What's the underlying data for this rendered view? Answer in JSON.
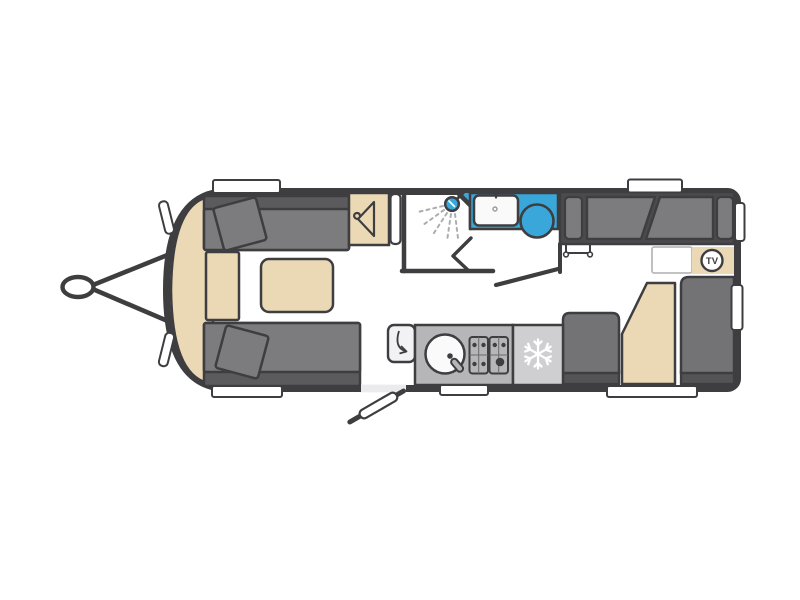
{
  "page": {
    "title": "Caravan floor plan (top-down layout diagram)",
    "background": "#ffffff"
  },
  "labels": {
    "tv": "TV"
  },
  "colors": {
    "outline_wall": "#3E3E40",
    "floor": "#EBEBED",
    "upholstery_gray": "#7C7C7E",
    "upholstery_dark": "#5B5B5D",
    "bed_base_dark": "#4B4B4D",
    "dinette_gray": "#737375",
    "wood_beige": "#EBD9B6",
    "wet_area_blue": "#3AA7DA",
    "worktop_gray": "#B6B6B8",
    "fridge_gray": "#CFCFD1",
    "white": "#FFFFFF",
    "spray_gray": "#ADADAF"
  },
  "icons": [
    "coat-hanger-icon",
    "shower-head-icon",
    "snowflake-icon",
    "tv-badge-icon",
    "hob-burners-icon",
    "sink-tap-icon",
    "flap-swing-arrow-icon"
  ],
  "floorplan": {
    "view": "top-down",
    "hitch": "A-frame tow hitch on left (front) end",
    "areas": [
      {
        "name": "front-lounge",
        "features": [
          "sofa with cushion (top)",
          "sofa with cushion (bottom)",
          "curved front shelf",
          "chest of drawers",
          "coffee table"
        ]
      },
      {
        "name": "wardrobe",
        "features": [
          "coat hanger symbol",
          "tall mirror/door strip"
        ]
      },
      {
        "name": "washroom",
        "features": [
          "shower with spray",
          "bi-fold shower door",
          "blue vanity counter",
          "washbasin with tap",
          "toilet",
          "open washroom door"
        ]
      },
      {
        "name": "kitchen",
        "features": [
          "fold-out worktop flap",
          "round sink with tap",
          "4-burner hob",
          "fridge with snowflake symbol"
        ]
      },
      {
        "name": "rear-lounge",
        "features": [
          "bench/bed with two backrest cushions and armrests",
          "pull-out support bracket",
          "white worktop",
          "TV point cabinet",
          "dinette seat left",
          "dinette table with angled corner",
          "dinette seat right"
        ]
      }
    ],
    "entry_door": "open entrance door on bottom wall between lounge and kitchen",
    "windows": {
      "top_wall": 2,
      "bottom_wall": 3,
      "right_wall": 2,
      "front_curve_markers": 2
    }
  }
}
